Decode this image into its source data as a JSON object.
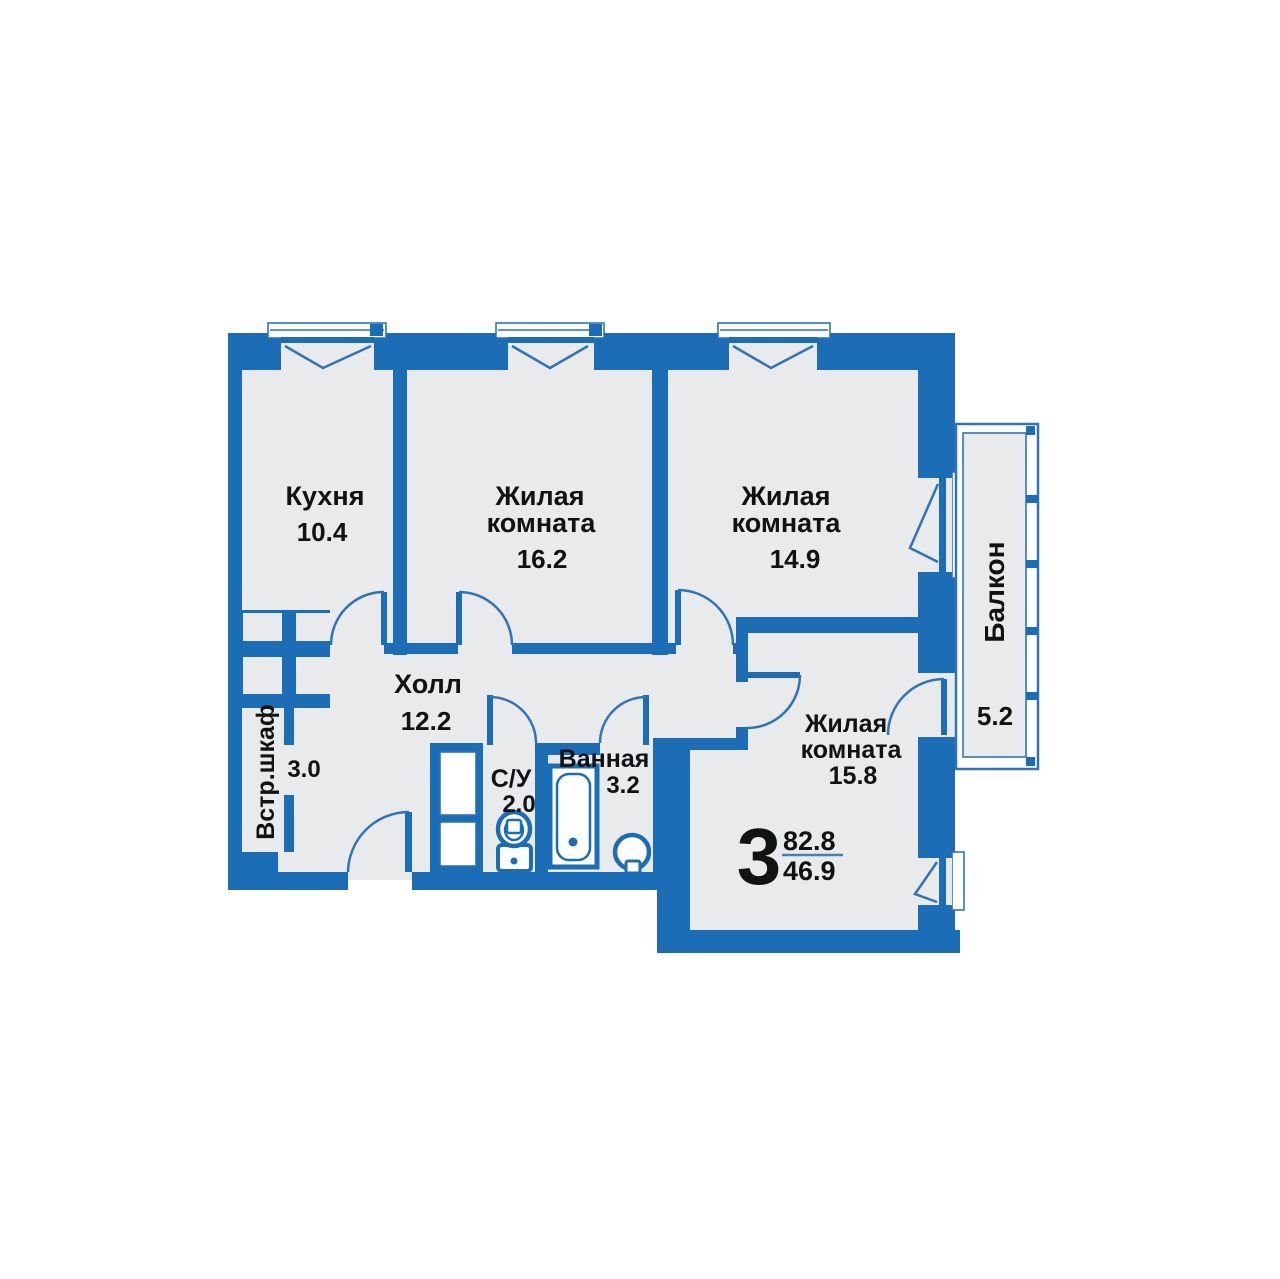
{
  "plan": {
    "summary": {
      "rooms_count": "3",
      "total_area": "82.8",
      "living_area": "46.9"
    },
    "rooms": [
      {
        "id": "kitchen",
        "name_lines": [
          "Кухня"
        ],
        "area": "10.4"
      },
      {
        "id": "living-1",
        "name_lines": [
          "Жилая",
          "комната"
        ],
        "area": "16.2"
      },
      {
        "id": "living-2",
        "name_lines": [
          "Жилая",
          "комната"
        ],
        "area": "14.9"
      },
      {
        "id": "living-3",
        "name_lines": [
          "Жилая",
          "комната"
        ],
        "area": "15.8"
      },
      {
        "id": "hall",
        "name_lines": [
          "Холл"
        ],
        "area": "12.2"
      },
      {
        "id": "closet",
        "name_lines": [
          "Встр.шкаф"
        ],
        "area": "3.0"
      },
      {
        "id": "wc",
        "name_lines": [
          "С/У"
        ],
        "area": "2.0"
      },
      {
        "id": "bathroom",
        "name_lines": [
          "Ванная"
        ],
        "area": "3.2"
      },
      {
        "id": "balcony",
        "name_lines": [
          "Балкон"
        ],
        "area": "5.2"
      }
    ],
    "fixtures": {
      "toilet": "toilet-icon",
      "bathtub": "bathtub-icon",
      "sink": "sink-icon"
    },
    "colors": {
      "wall": "#1b6db6",
      "floor": "#e9eaec",
      "fraction_line": "#4a7fb5",
      "text": "#121212"
    }
  }
}
